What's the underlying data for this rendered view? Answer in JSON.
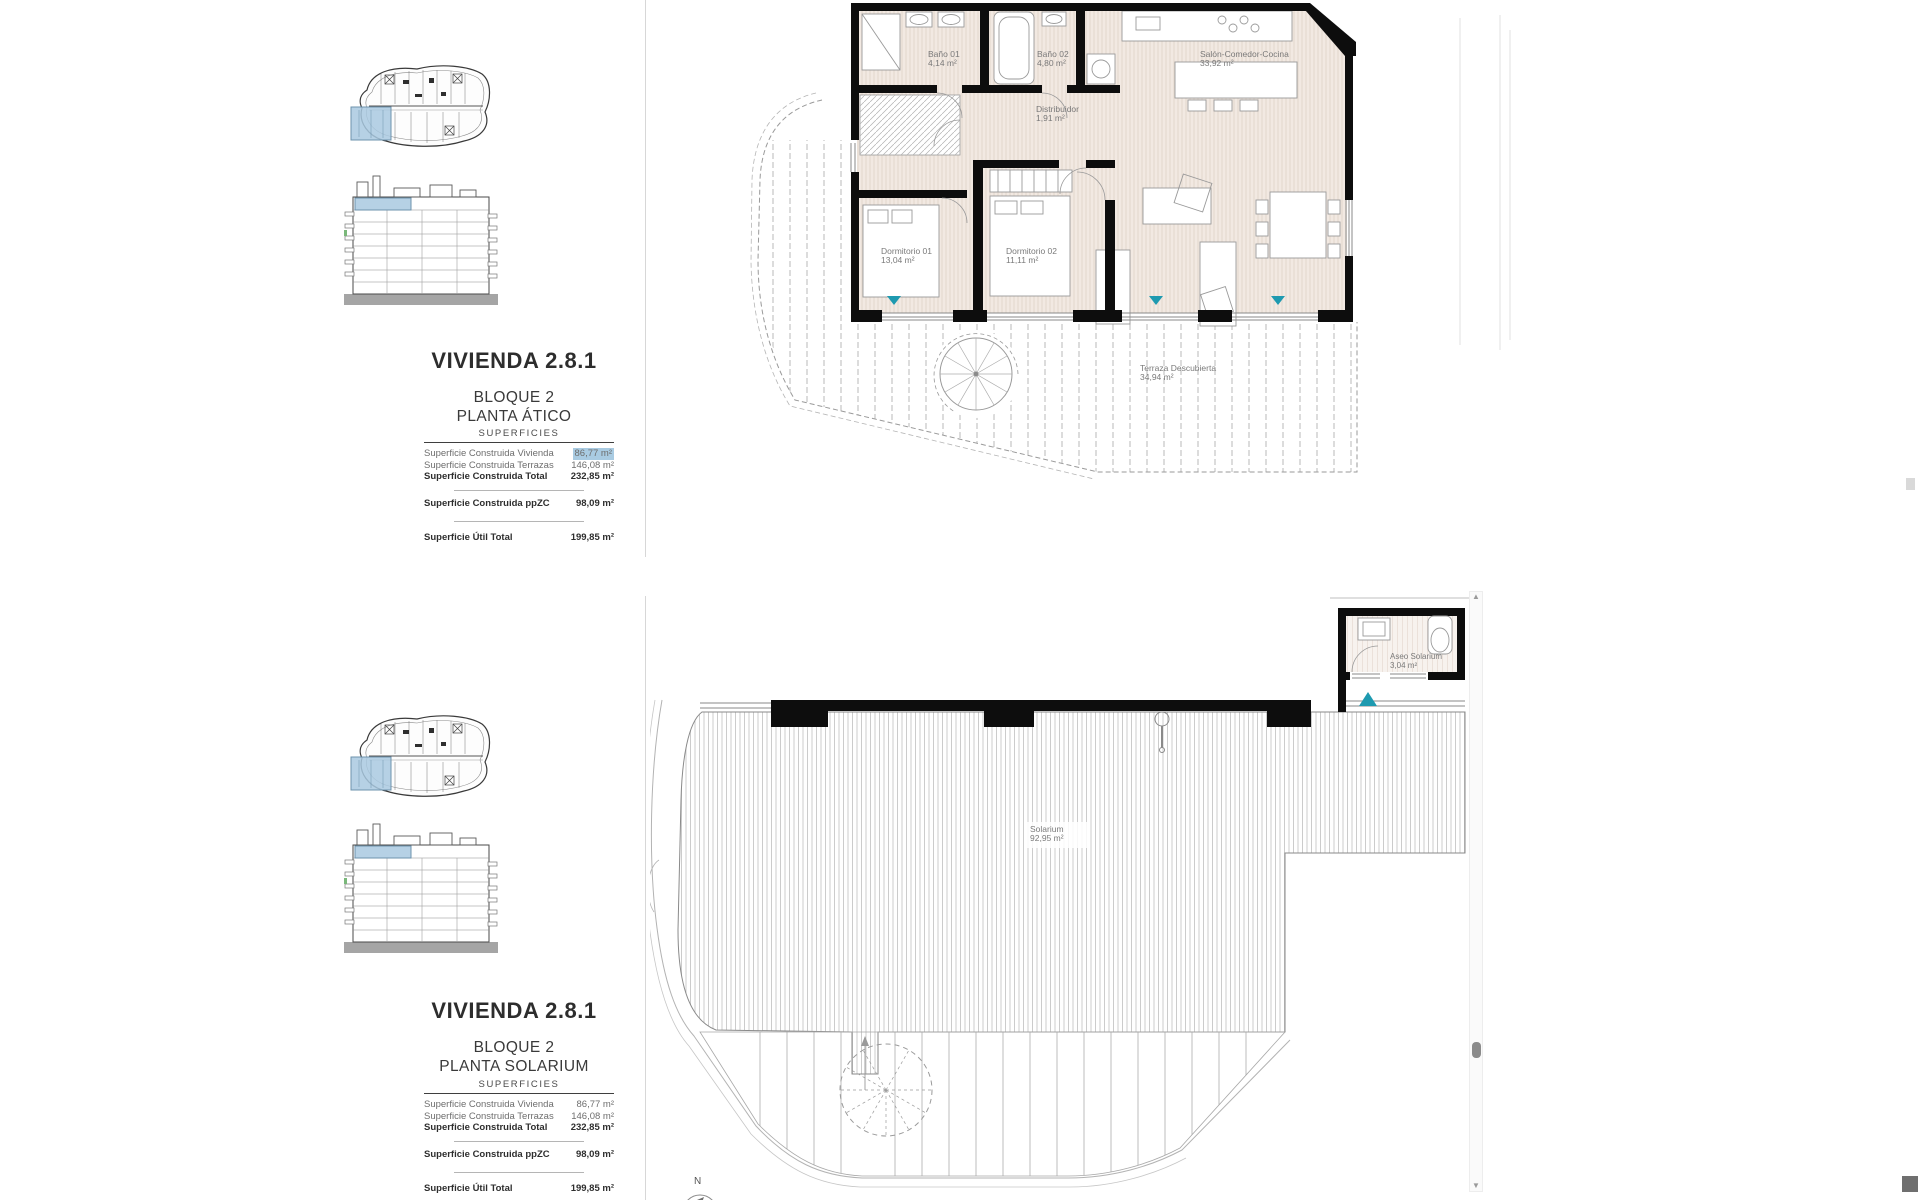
{
  "colors": {
    "highlight_blue": "#a9cbe2",
    "location_blue": "#a9c9e0",
    "teal_marker": "#1e9ab0",
    "wall_black": "#0d0d0d",
    "floor_beige": "#f2e9e2"
  },
  "panels": [
    {
      "title": "VIVIENDA 2.8.1",
      "block": "BLOQUE 2",
      "floor": "PLANTA ÁTICO",
      "superficies": {
        "header": "SUPERFICIES",
        "rows": [
          {
            "label": "Superficie Construida Vivienda",
            "value": "86,77 m²"
          },
          {
            "label": "Superficie Construida Terrazas",
            "value": "146,08 m²"
          },
          {
            "label": "Superficie Construida Total",
            "value": "232,85 m²"
          },
          {
            "label": "Superficie Construida ppZC",
            "value": "98,09 m²"
          },
          {
            "label": "Superficie Útil Total",
            "value": "199,85 m²"
          }
        ]
      },
      "plan": {
        "rooms": [
          {
            "name": "Baño 01",
            "area": "4,14 m²"
          },
          {
            "name": "Baño 02",
            "area": "4,80 m²"
          },
          {
            "name": "Salón-Comedor-Cocina",
            "area": "33,92 m²"
          },
          {
            "name": "Distribuidor",
            "area": "1,91 m²"
          },
          {
            "name": "Dormitorio 01",
            "area": "13,04 m²"
          },
          {
            "name": "Dormitorio 02",
            "area": "11,11 m²"
          },
          {
            "name": "Terraza Descubierta",
            "area": "34,94 m²"
          }
        ]
      }
    },
    {
      "title": "VIVIENDA 2.8.1",
      "block": "BLOQUE 2",
      "floor": "PLANTA SOLARIUM",
      "superficies": {
        "header": "SUPERFICIES",
        "rows": [
          {
            "label": "Superficie Construida Vivienda",
            "value": "86,77 m²"
          },
          {
            "label": "Superficie Construida Terrazas",
            "value": "146,08 m²"
          },
          {
            "label": "Superficie Construida Total",
            "value": "232,85 m²"
          },
          {
            "label": "Superficie Construida ppZC",
            "value": "98,09 m²"
          },
          {
            "label": "Superficie Útil Total",
            "value": "199,85 m²"
          }
        ]
      },
      "plan": {
        "rooms": [
          {
            "name": "Solarium",
            "area": "92,95 m²"
          },
          {
            "name": "Aseo Solarium",
            "area": "3,04 m²"
          }
        ],
        "compass_north": "N"
      }
    }
  ]
}
